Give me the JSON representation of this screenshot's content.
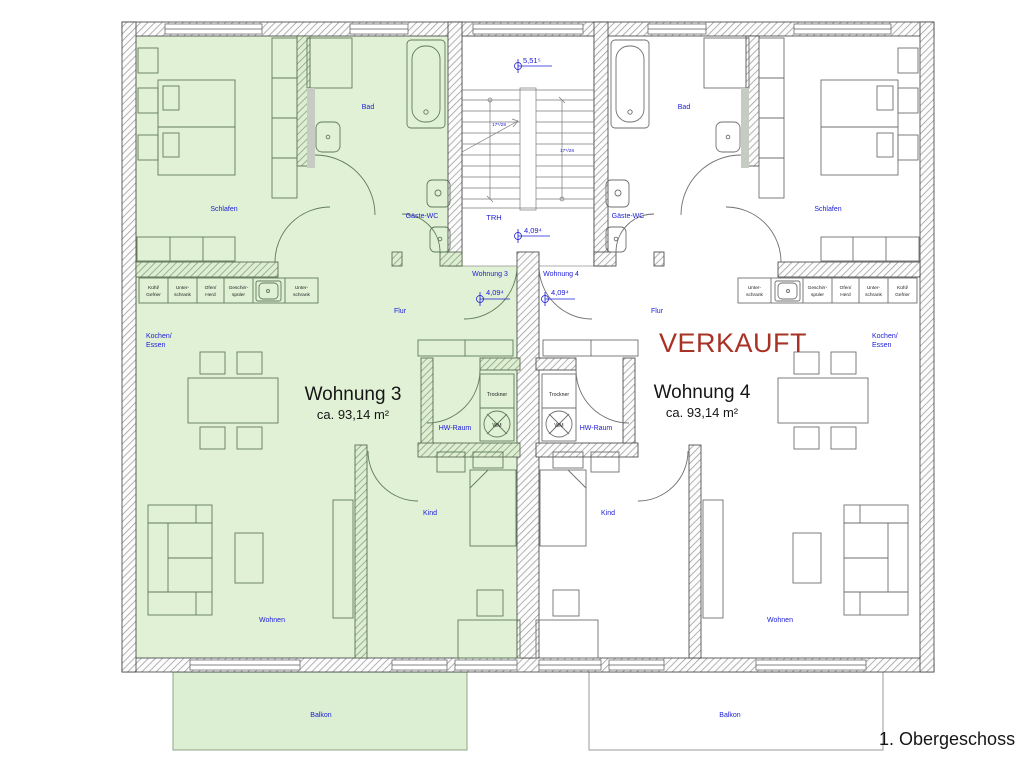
{
  "page": {
    "floor_label": "1. Obergeschoss"
  },
  "colors": {
    "label_blue": "#1b1bd6",
    "sold_red": "#a93226",
    "highlight_green": "#e0f1d6",
    "furniture_green_stroke": "#5f7c57",
    "furniture_gray_stroke": "#6f6f6f"
  },
  "sold_stamp": "VERKAUFT",
  "apartments": {
    "wohnung3": {
      "name": "Wohnung 3",
      "area": "ca. 93,14 m²",
      "door_label": "Wohnung 3"
    },
    "wohnung4": {
      "name": "Wohnung 4",
      "area": "ca. 93,14 m²",
      "door_label": "Wohnung 4"
    }
  },
  "rooms": {
    "schlafen": "Schlafen",
    "bad": "Bad",
    "gaeste_wc": "Gäste-WC",
    "trh": "TRH",
    "flur": "Flur",
    "kochen_line1": "Kochen/",
    "kochen_line2": "Essen",
    "wohnen": "Wohnen",
    "kind": "Kind",
    "hw_raum": "HW-Raum",
    "balkon": "Balkon"
  },
  "appliances": {
    "trockner": "Trockner",
    "wm": "WM"
  },
  "kitchen_cells": [
    {
      "l1": "Kühl/",
      "l2": "Gefrier"
    },
    {
      "l1": "Unter-",
      "l2": "schrank"
    },
    {
      "l1": "Ofen/",
      "l2": "Herd"
    },
    {
      "l1": "Geschirr-",
      "l2": "spüler"
    }
  ],
  "measurements": {
    "level_top": "5,51⁵",
    "level_landing": "4,09⁴",
    "level_w3_door": "4,09⁴",
    "level_w4_door": "4,09⁴",
    "stair_flight_left": "17⁵/28",
    "stair_flight_right": "17⁵/28"
  }
}
